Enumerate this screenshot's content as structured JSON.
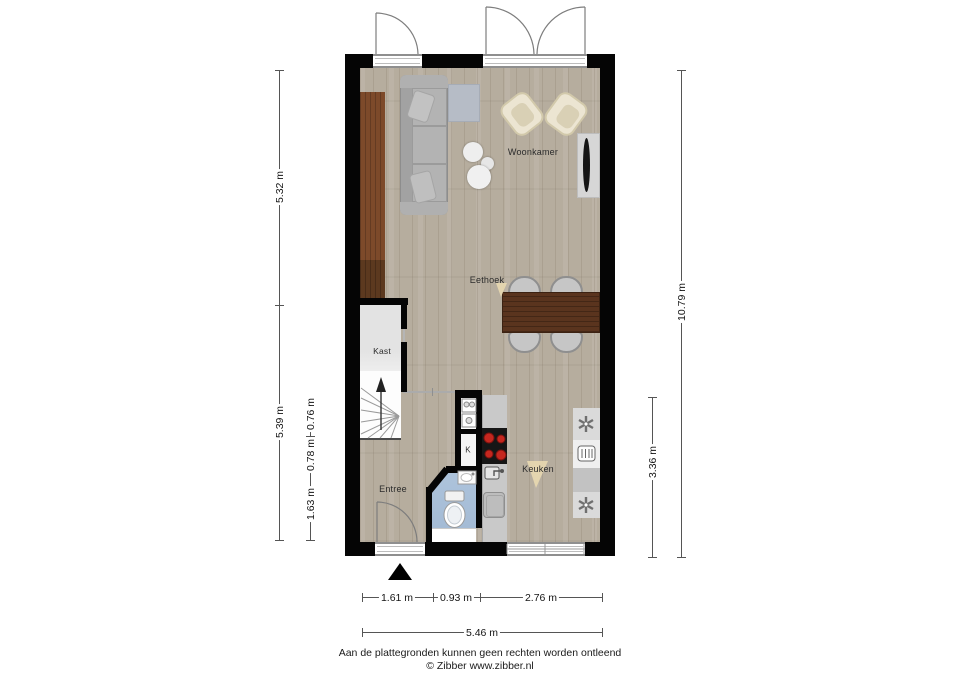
{
  "rooms": {
    "woonkamer": "Woonkamer",
    "eethoek": "Eethoek",
    "kast": "Kast",
    "entree": "Entree",
    "keuken": "Keuken",
    "meterkast": "K"
  },
  "dimensions": {
    "left_outer": [
      "5.32 m",
      "5.39 m"
    ],
    "left_inner": [
      "0.76 m",
      "0.78 m",
      "1.63 m"
    ],
    "right_outer": "10.79 m",
    "right_inner": "3.36 m",
    "bottom_segments": [
      "1.61 m",
      "0.93 m",
      "2.76 m"
    ],
    "bottom_total": "5.46 m"
  },
  "footer": {
    "disclaimer": "Aan de plattegronden kunnen geen rechten worden ontleend",
    "copyright": "© Zibber www.zibber.nl"
  },
  "icons": {
    "entrance_marker": "triangle-up",
    "stairs_direction": "arrow-up",
    "appliance_star": "asterisk",
    "oven": "boxed-grill",
    "cooktop": "four-burners",
    "toilet": "toilet-top-view",
    "sink": "sink-top-view",
    "tv": "tv-on-cabinet"
  },
  "colors": {
    "wall": "#050505",
    "floor": "#b6ad9e",
    "wardrobe_wood": "#7d4a2a",
    "table_wood": "#5a341e",
    "bathroom_floor": "#a9c0d9",
    "burner_red": "#c5271f",
    "dimension_text": "#141414"
  }
}
